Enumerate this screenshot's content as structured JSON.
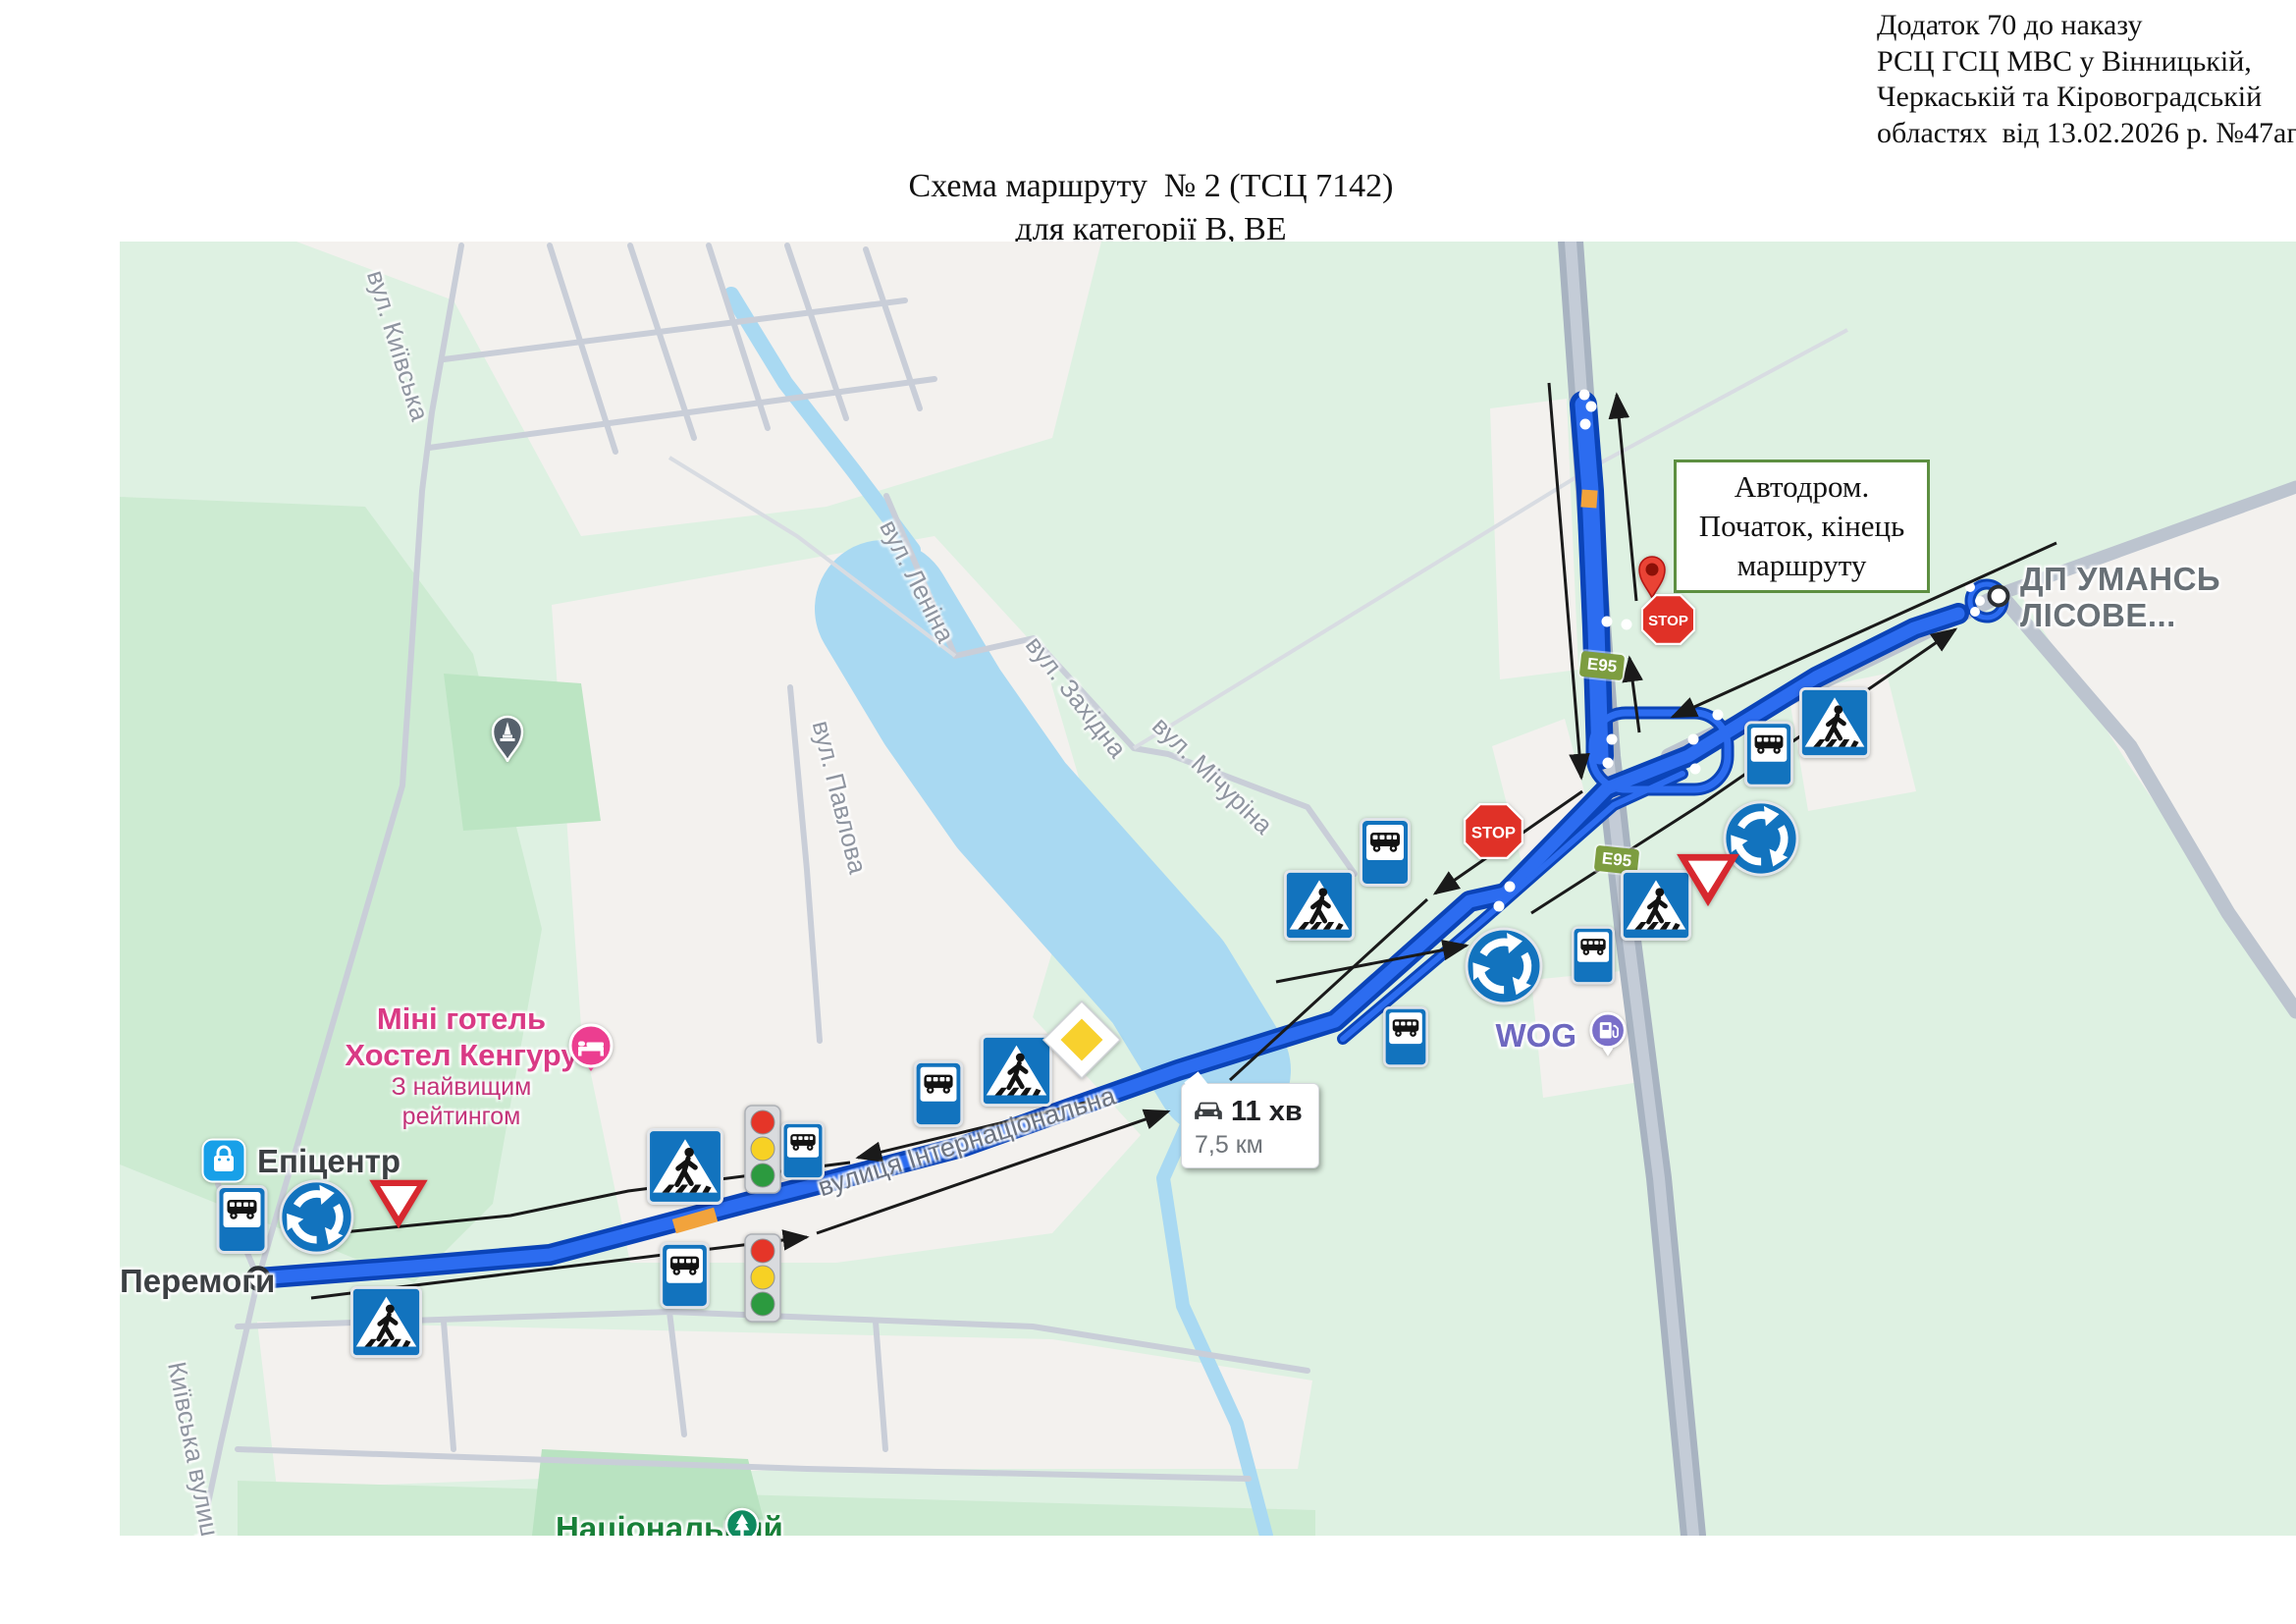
{
  "annotation": {
    "line1": "Додаток 70 до наказу",
    "line2": "РСЦ ГСЦ МВС у Вінницькій,",
    "line3": "Черкаській та Кіровоградській",
    "line4": "областях  від 13.02.2026 р. №47аг"
  },
  "title": {
    "line1": "Схема маршруту  № 2 (ТСЦ 7142)",
    "line2": "для категорії В, ВЕ"
  },
  "map": {
    "autodrome_label": {
      "line1": "Автодром.",
      "line2": "Початок, кінець",
      "line3": "маршруту"
    },
    "route_info": {
      "duration": "11 хв",
      "distance": "7,5 км"
    },
    "poi": {
      "peremohy": "Перемоги",
      "epicentr": "Епіцентр",
      "hotel_line1": "Міні готель",
      "hotel_line2": "Хостел Кенгуру",
      "hotel_line3": "З найвищим рейтингом",
      "wog": "WOG",
      "national": "Національний",
      "dp_uman_line1": "ДП УМАНСЬ",
      "dp_uman_line2": "ЛІСОВЕ..."
    },
    "streets": {
      "kyivska": "вул. Київська",
      "lenina": "вул. Леніна",
      "zakhidna": "вул. Західна",
      "michurina": "вул. Мічуріна",
      "pavlova": "вул. Павлова",
      "internatsionalna": "вулиця Інтернаціональна",
      "kyivska_vulytsia": "Київська вулиця"
    },
    "badges": {
      "e95": "E95"
    },
    "signs": {
      "stop": "STOP"
    },
    "colors": {
      "route_blue": "#2c6cf0",
      "route_dark": "#0b44b8",
      "water": "#a9d9f2",
      "urban": "#f3f1ee",
      "base_green": "#def1e2",
      "sign_blue": "#1273be",
      "stop_red": "#e03127",
      "label_green_border": "#5d8f41"
    }
  }
}
